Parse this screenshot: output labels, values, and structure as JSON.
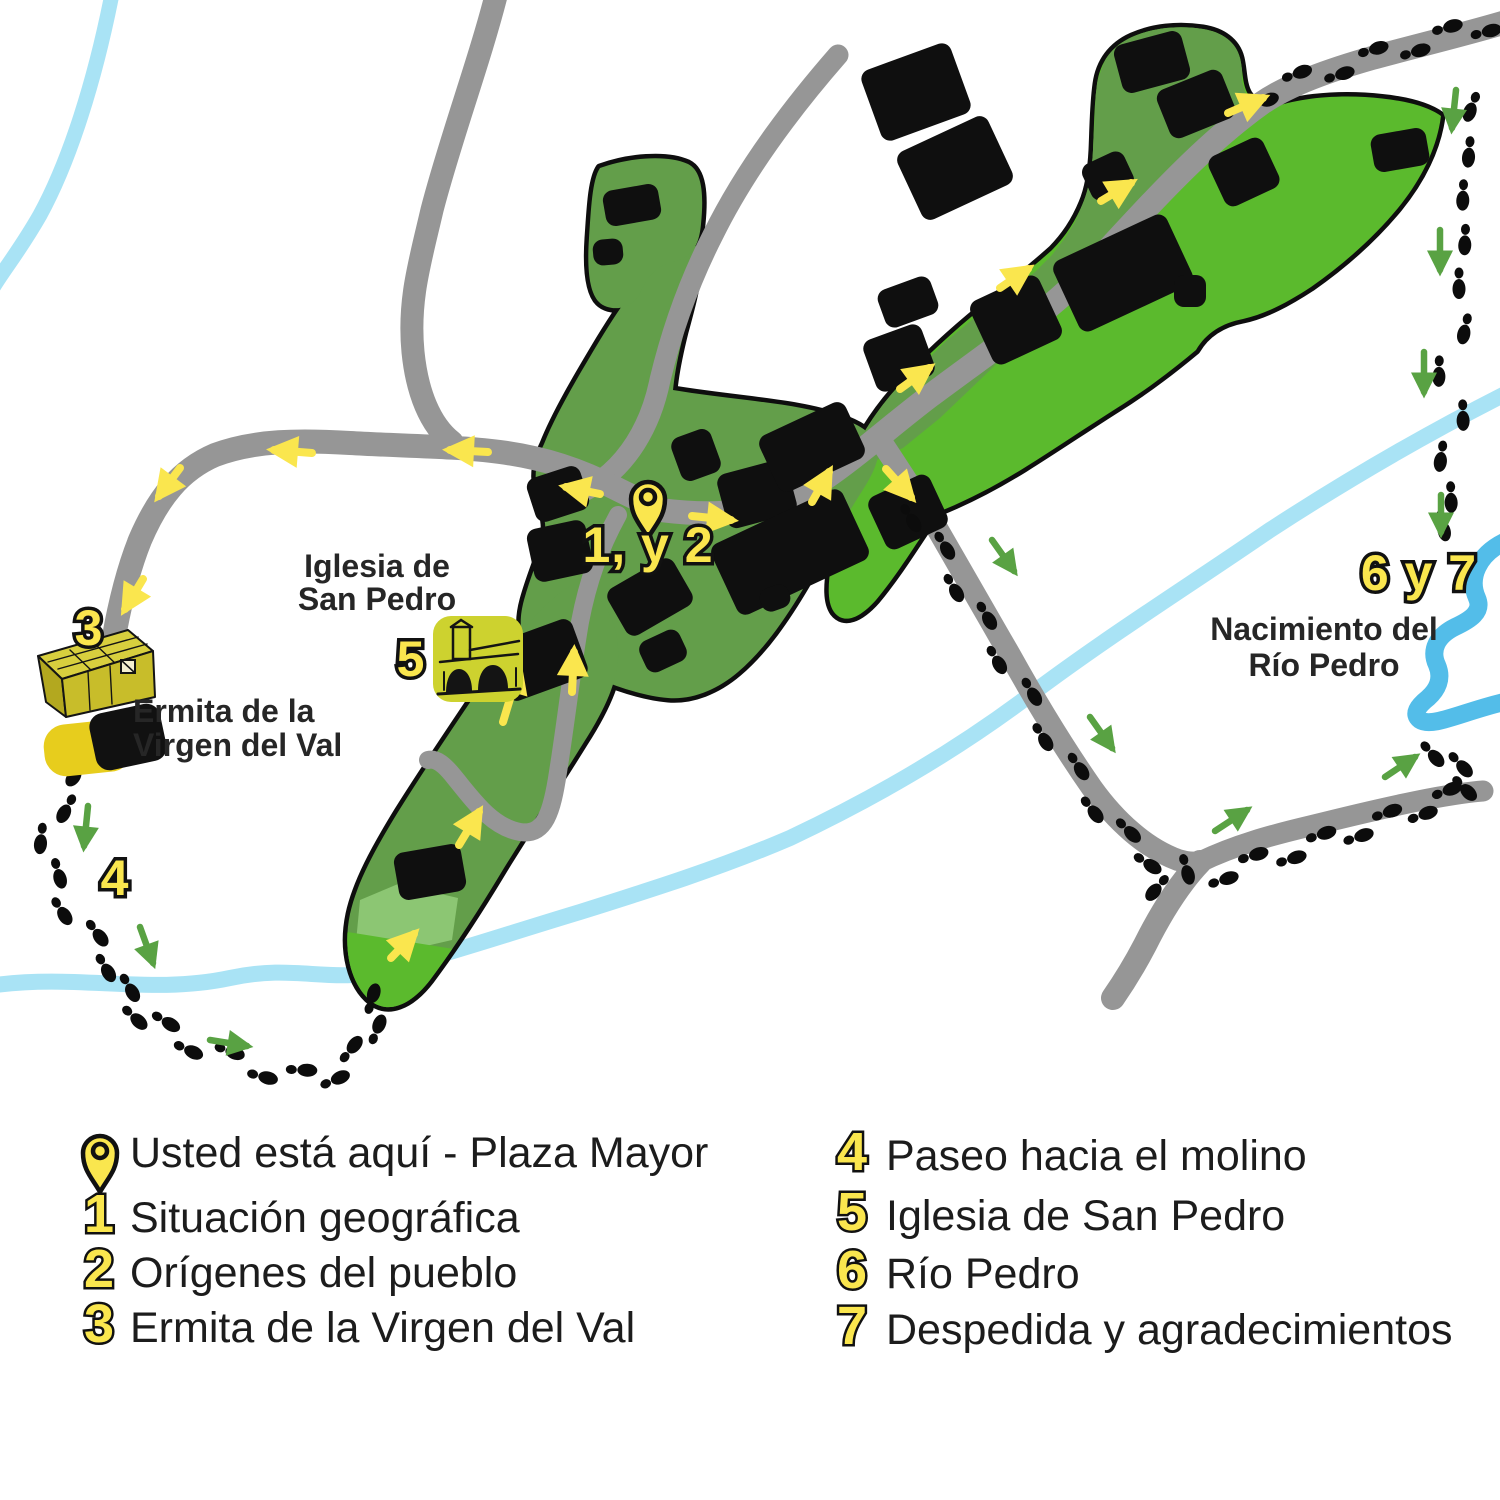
{
  "map": {
    "pin_label": "1, y 2",
    "markers": {
      "m3": "3",
      "m4": "4",
      "m5": "5",
      "m67": "6 y 7"
    },
    "labels": {
      "iglesia": {
        "line1": "Iglesia de",
        "line2": "San Pedro"
      },
      "ermita": {
        "line1": "Ermita de la",
        "line2": "Virgen del Val"
      },
      "nacimiento": {
        "line1": "Nacimiento del",
        "line2": "Río Pedro"
      }
    }
  },
  "legend": {
    "you_are_here": "Usted está aquí - Plaza Mayor",
    "items": [
      {
        "number": "1",
        "label": "Situación geográfica"
      },
      {
        "number": "2",
        "label": "Orígenes del pueblo"
      },
      {
        "number": "3",
        "label": "Ermita de la Virgen del Val"
      },
      {
        "number": "4",
        "label": "Paseo hacia el molino"
      },
      {
        "number": "5",
        "label": "Iglesia de San Pedro"
      },
      {
        "number": "6",
        "label": "Río Pedro"
      },
      {
        "number": "7",
        "label": "Despedida y agradecimientos"
      }
    ]
  },
  "colors": {
    "village_green_dark": "#639E4A",
    "village_green_bright": "#5BBA2D",
    "village_green_light": "#8CC673",
    "road_gray": "#969696",
    "river_light": "#A9E3F5",
    "river_dark": "#53BDE9",
    "marker_yellow": "#FAE64E",
    "icon_yellow": "#CDD22F",
    "gold_blob": "#E7CD1D",
    "arrow_green": "#59A243",
    "building_black": "#0f0f0f"
  }
}
